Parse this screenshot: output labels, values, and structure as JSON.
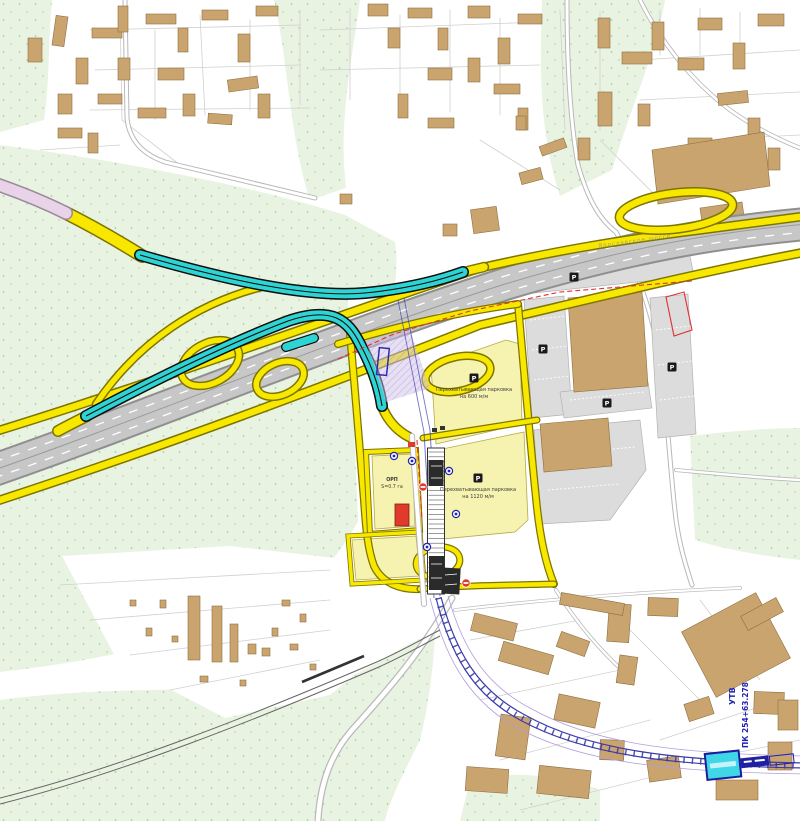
{
  "colors": {
    "green": "#e9f3e1",
    "green_dot": "#a5c9a0",
    "parcel_line": "#d0d0d0",
    "road_minor": "#b8b8b8",
    "hw_fill": "#c7c7c7",
    "hw_casing": "#8f8f8f",
    "yellow": "#f8e800",
    "yellow_casing": "#7d7500",
    "pale_cell": "#f6f2b0",
    "cell_stroke": "#b7ab45",
    "cyan": "#2ed4d4",
    "cyan_casing": "#0d0d0d",
    "pink": "#e9d3e9",
    "building": "#c9a46f",
    "building_stroke": "#8e6f3f",
    "gray_parking": "#dcdcdc",
    "red": "#e23a2a",
    "red_line": "#e03030",
    "rail_blue": "#3a3aad",
    "lavender": "#cfc0e8",
    "label_dark": "#3d3d3d",
    "blue_label": "#2424b2",
    "station_cyan": "#3fd6e8"
  },
  "labels": {
    "parking_upper_l1": "Перехватывающая парковка",
    "parking_upper_l2": "на 600 м/м",
    "parking_lower_l1": "Перехватывающая парковка",
    "parking_lower_l2": "на 1120 м/м",
    "orp_l1": "ОРП",
    "orp_l2": "S=0.7 га",
    "utv": "УТВ",
    "pk": "ПК 254+63.278",
    "highway_name": "Ярославское шоссе"
  },
  "icons": {
    "parking_glyph": "P",
    "parking_positions": [
      [
        474,
        378
      ],
      [
        478,
        478
      ],
      [
        543,
        349
      ],
      [
        607,
        403
      ],
      [
        672,
        367
      ],
      [
        574,
        277
      ]
    ],
    "bus_stop_positions": [
      [
        412,
        461
      ],
      [
        449,
        471
      ],
      [
        427,
        547
      ],
      [
        394,
        456
      ],
      [
        456,
        514
      ]
    ],
    "no_entry_positions": [
      [
        423,
        487
      ],
      [
        466,
        583
      ]
    ]
  },
  "map": {
    "buildings_nw": [
      [
        28,
        38,
        14,
        24,
        0
      ],
      [
        54,
        16,
        12,
        30,
        8
      ],
      [
        76,
        58,
        12,
        26,
        0
      ],
      [
        58,
        94,
        14,
        20,
        0
      ],
      [
        92,
        28,
        30,
        10,
        0
      ],
      [
        118,
        6,
        10,
        26,
        0
      ],
      [
        146,
        14,
        30,
        10,
        0
      ],
      [
        178,
        28,
        10,
        24,
        0
      ],
      [
        202,
        10,
        26,
        10,
        0
      ],
      [
        238,
        34,
        12,
        28,
        0
      ],
      [
        256,
        6,
        22,
        10,
        0
      ],
      [
        228,
        78,
        30,
        12,
        -8
      ],
      [
        258,
        94,
        12,
        24,
        0
      ],
      [
        158,
        68,
        26,
        12,
        0
      ],
      [
        118,
        58,
        12,
        22,
        0
      ],
      [
        98,
        94,
        24,
        10,
        0
      ],
      [
        138,
        108,
        28,
        10,
        0
      ],
      [
        183,
        94,
        12,
        22,
        0
      ],
      [
        208,
        114,
        24,
        10,
        4
      ],
      [
        58,
        128,
        24,
        10,
        0
      ],
      [
        88,
        133,
        10,
        20,
        0
      ],
      [
        368,
        4,
        20,
        12,
        0
      ],
      [
        388,
        28,
        12,
        20,
        0
      ],
      [
        408,
        8,
        24,
        10,
        0
      ],
      [
        438,
        28,
        10,
        22,
        0
      ],
      [
        468,
        6,
        22,
        12,
        0
      ],
      [
        498,
        38,
        12,
        26,
        0
      ],
      [
        518,
        14,
        24,
        10,
        0
      ],
      [
        468,
        58,
        12,
        24,
        0
      ],
      [
        494,
        84,
        26,
        10,
        0
      ],
      [
        518,
        108,
        10,
        22,
        0
      ],
      [
        428,
        68,
        24,
        12,
        0
      ],
      [
        398,
        94,
        10,
        24,
        0
      ],
      [
        428,
        118,
        26,
        10,
        0
      ],
      [
        598,
        18,
        12,
        30,
        0
      ],
      [
        622,
        52,
        30,
        12,
        0
      ],
      [
        652,
        22,
        12,
        28,
        0
      ],
      [
        678,
        58,
        26,
        12,
        0
      ],
      [
        698,
        18,
        24,
        12,
        0
      ],
      [
        733,
        43,
        12,
        26,
        0
      ],
      [
        758,
        14,
        26,
        12,
        0
      ],
      [
        718,
        92,
        30,
        12,
        -6
      ],
      [
        748,
        118,
        12,
        24,
        0
      ],
      [
        688,
        138,
        24,
        12,
        0
      ],
      [
        768,
        148,
        12,
        22,
        0
      ],
      [
        598,
        92,
        14,
        34,
        0
      ],
      [
        578,
        138,
        12,
        22,
        0
      ],
      [
        638,
        104,
        12,
        22,
        0
      ],
      [
        472,
        208,
        26,
        24,
        -8
      ],
      [
        443,
        224,
        14,
        12,
        0
      ],
      [
        340,
        194,
        12,
        10,
        0
      ],
      [
        516,
        116,
        10,
        14,
        0
      ],
      [
        540,
        142,
        26,
        10,
        -20
      ],
      [
        520,
        170,
        22,
        12,
        -15
      ]
    ],
    "buildings_se": [
      [
        472,
        618,
        44,
        18,
        14
      ],
      [
        500,
        648,
        52,
        20,
        16
      ],
      [
        558,
        636,
        30,
        16,
        20
      ],
      [
        608,
        604,
        22,
        38,
        4
      ],
      [
        648,
        598,
        30,
        18,
        2
      ],
      [
        694,
        608,
        84,
        74,
        -28
      ],
      [
        754,
        692,
        30,
        22,
        2
      ],
      [
        686,
        700,
        26,
        18,
        -18
      ],
      [
        618,
        656,
        18,
        28,
        8
      ],
      [
        556,
        698,
        42,
        26,
        12
      ],
      [
        498,
        716,
        30,
        42,
        8
      ],
      [
        466,
        768,
        42,
        24,
        4
      ],
      [
        538,
        768,
        52,
        28,
        6
      ],
      [
        600,
        740,
        24,
        20,
        2
      ],
      [
        648,
        758,
        32,
        22,
        -8
      ],
      [
        716,
        780,
        42,
        20,
        0
      ],
      [
        768,
        742,
        24,
        28,
        0
      ],
      [
        560,
        598,
        64,
        12,
        10
      ],
      [
        742,
        606,
        40,
        16,
        -28
      ],
      [
        778,
        700,
        20,
        30,
        0
      ]
    ],
    "buildings_allotment": [
      [
        188,
        596,
        12,
        64,
        0
      ],
      [
        212,
        606,
        10,
        56,
        0
      ],
      [
        230,
        624,
        8,
        38,
        0
      ],
      [
        248,
        644,
        8,
        10,
        0
      ],
      [
        262,
        648,
        8,
        8,
        0
      ],
      [
        160,
        600,
        6,
        8,
        0
      ],
      [
        172,
        636,
        6,
        6,
        0
      ],
      [
        146,
        628,
        6,
        8,
        0
      ],
      [
        200,
        676,
        8,
        6,
        0
      ],
      [
        240,
        680,
        6,
        6,
        0
      ],
      [
        272,
        628,
        6,
        8,
        0
      ],
      [
        290,
        644,
        8,
        6,
        0
      ],
      [
        300,
        614,
        6,
        8,
        0
      ],
      [
        310,
        664,
        6,
        6,
        0
      ],
      [
        130,
        600,
        6,
        6,
        0
      ],
      [
        282,
        600,
        8,
        6,
        0
      ]
    ],
    "parcel_lines": [
      [
        120,
        8,
        122,
        120
      ],
      [
        122,
        120,
        180,
        165
      ],
      [
        180,
        165,
        300,
        195
      ],
      [
        40,
        150,
        120,
        145
      ],
      [
        155,
        30,
        155,
        120
      ],
      [
        200,
        15,
        205,
        115
      ],
      [
        250,
        20,
        250,
        110
      ],
      [
        300,
        10,
        300,
        105
      ],
      [
        350,
        8,
        350,
        100
      ],
      [
        400,
        15,
        400,
        108
      ],
      [
        450,
        10,
        450,
        112
      ],
      [
        500,
        18,
        500,
        115
      ],
      [
        90,
        30,
        300,
        25
      ],
      [
        95,
        70,
        300,
        65
      ],
      [
        90,
        110,
        310,
        108
      ],
      [
        320,
        30,
        540,
        22
      ],
      [
        320,
        70,
        540,
        65
      ],
      [
        560,
        10,
        565,
        130
      ],
      [
        600,
        12,
        600,
        130
      ],
      [
        640,
        60,
        800,
        50
      ],
      [
        640,
        100,
        800,
        92
      ],
      [
        660,
        10,
        660,
        55
      ],
      [
        700,
        8,
        700,
        55
      ],
      [
        740,
        12,
        740,
        58
      ],
      [
        600,
        140,
        660,
        200
      ],
      [
        700,
        140,
        800,
        135
      ],
      [
        480,
        140,
        560,
        190
      ],
      [
        60,
        585,
        330,
        570
      ],
      [
        90,
        620,
        330,
        600
      ],
      [
        130,
        655,
        330,
        630
      ],
      [
        170,
        690,
        320,
        660
      ],
      [
        470,
        640,
        580,
        620
      ],
      [
        480,
        700,
        620,
        670
      ],
      [
        500,
        760,
        650,
        720
      ],
      [
        520,
        810,
        680,
        770
      ],
      [
        600,
        600,
        700,
        700
      ],
      [
        700,
        600,
        760,
        680
      ],
      [
        660,
        740,
        780,
        700
      ],
      [
        700,
        760,
        800,
        740
      ]
    ]
  }
}
